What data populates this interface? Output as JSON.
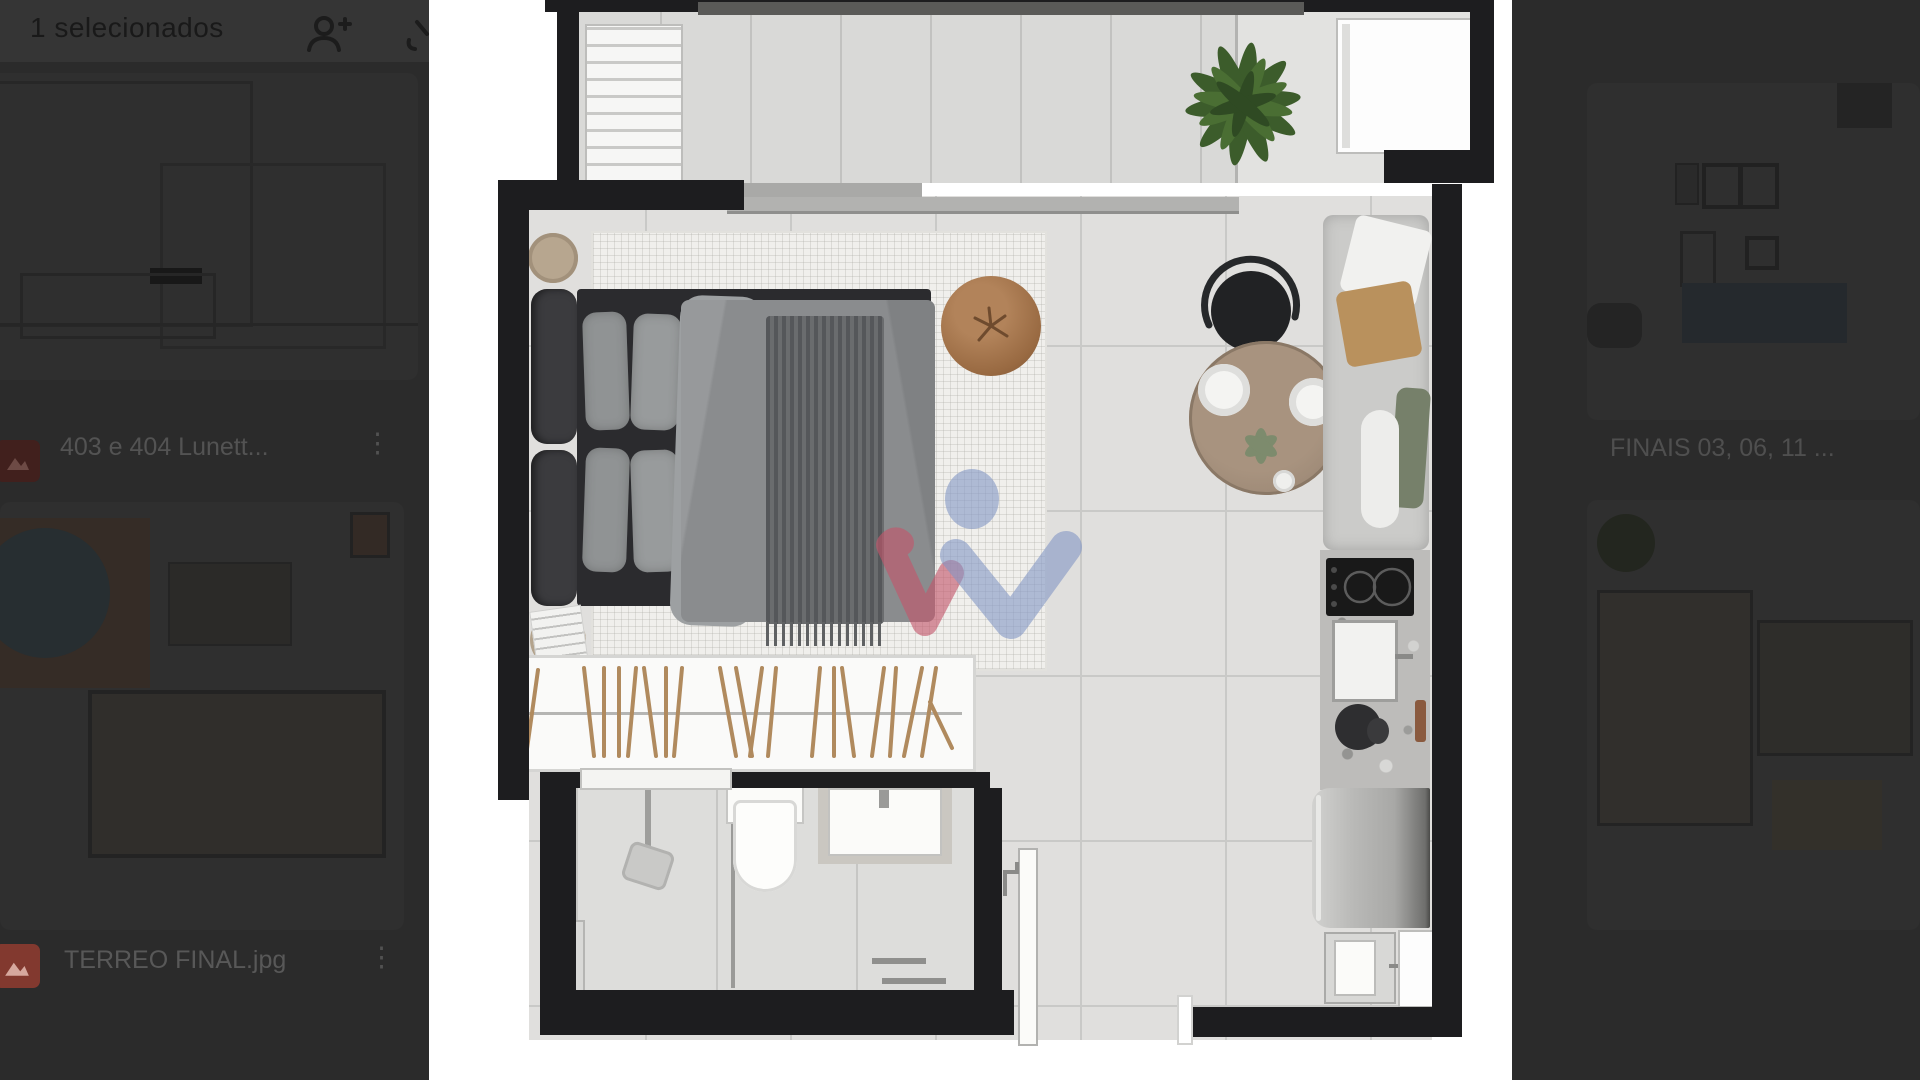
{
  "toolbar": {
    "selection_label": "1 selecionados",
    "icons": {
      "person_add": "person-add",
      "download_partial": "download"
    }
  },
  "left_panel": {
    "files": [
      {
        "name": "403 e 404 Lunett...",
        "menu_glyph": "⋮",
        "icon": "image-file"
      },
      {
        "name": "TERREO FINAL.jpg",
        "menu_glyph": "⋮",
        "icon": "image-file"
      }
    ]
  },
  "right_panel": {
    "files": [
      {
        "name": "FINAIS 03, 06, 11 ...",
        "menu_glyph": "⋮",
        "icon": "image-file"
      }
    ]
  },
  "preview": {
    "type": "floor-plan-render",
    "watermark_colors": {
      "blue": "#8296c4",
      "red": "#c4566b"
    },
    "accent_file_icon_color": "#82392f",
    "rooms": "studio: balcony, bedroom-living, kitchen, bathroom, wardrobe, entry"
  }
}
